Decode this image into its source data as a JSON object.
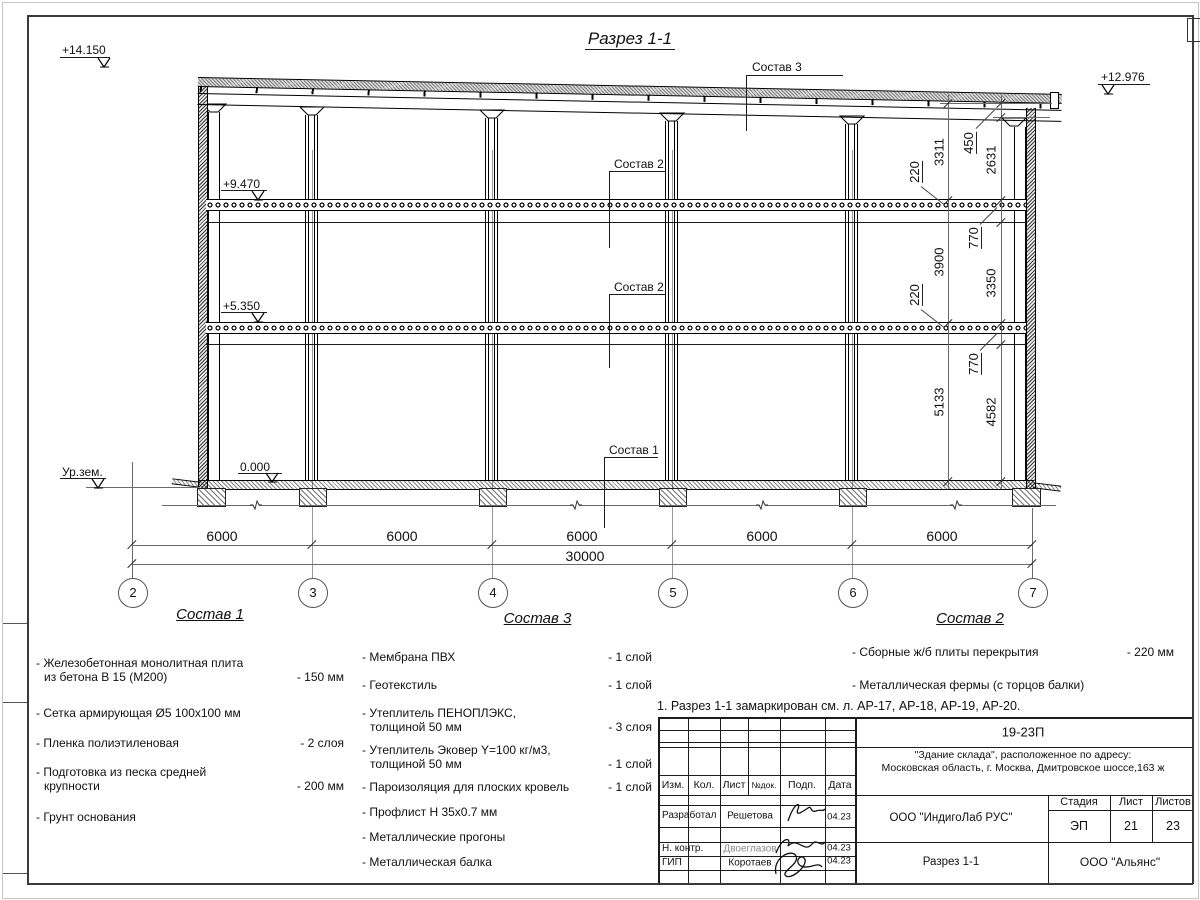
{
  "sheet": {
    "title": "Разрез 1-1",
    "note": "1. Разрез 1-1 замаркирован см. л. АР-17, АР-18, АР-19, АР-20."
  },
  "elevations": {
    "top_left": "+14.150",
    "top_right": "+12.976",
    "floor2": "+9.470",
    "floor1": "+5.350",
    "zero": "0.000",
    "ground": "Ур.зем."
  },
  "callouts": {
    "roof": "Состав 3",
    "slab_upper": "Состав 2",
    "slab_lower": "Состав 2",
    "floor_slab": "Состав 1"
  },
  "grid": {
    "labels": [
      "2",
      "3",
      "4",
      "5",
      "6",
      "7"
    ]
  },
  "dimensions": {
    "bottom_bays": [
      "6000",
      "6000",
      "6000",
      "6000",
      "6000"
    ],
    "bottom_total": "30000",
    "right_inner": [
      "3311",
      "3900",
      "5133"
    ],
    "right_outer": [
      "450",
      "2631",
      "770",
      "3350",
      "770",
      "4582"
    ],
    "slab_thickness": [
      "220",
      "220"
    ]
  },
  "legends": [
    {
      "title": "Состав 1",
      "items": [
        {
          "line1": "- Железобетонная  монолитная плита",
          "line2": "из бетона В 15 (М200)",
          "value": "- 150 мм"
        },
        {
          "line1": "- Сетка армирующая Ø5 100x100 мм",
          "line2": "",
          "value": ""
        },
        {
          "line1": "- Пленка полиэтиленовая",
          "line2": "",
          "value": "- 2 слоя"
        },
        {
          "line1": "- Подготовка из песка средней",
          "line2": "крупности",
          "value": "- 200 мм"
        },
        {
          "line1": "- Грунт основания",
          "line2": "",
          "value": ""
        }
      ]
    },
    {
      "title": "Состав 3",
      "items": [
        {
          "line1": "- Мембрана ПВХ",
          "line2": "",
          "value": "- 1 слой"
        },
        {
          "line1": "- Геотекстиль",
          "line2": "",
          "value": "- 1 слой"
        },
        {
          "line1": "- Утеплитель ПЕНОПЛЭКС,",
          "line2": "толщиной 50 мм",
          "value": "- 3 слоя"
        },
        {
          "line1": "- Утеплитель Эковер Y=100 кг/м3,",
          "line2": "толщиной 50 мм",
          "value": "- 1 слой"
        },
        {
          "line1": "- Пароизоляция для плоских кровель",
          "line2": "",
          "value": "- 1 слой"
        },
        {
          "line1": "- Профлист Н 35х0.7 мм",
          "line2": "",
          "value": ""
        },
        {
          "line1": "- Металлические прогоны",
          "line2": "",
          "value": ""
        },
        {
          "line1": "- Металлическая балка",
          "line2": "",
          "value": ""
        }
      ]
    },
    {
      "title": "Состав 2",
      "items": [
        {
          "line1": "- Сборные ж/б плиты перекрытия",
          "line2": "",
          "value": "- 220 мм"
        },
        {
          "line1": "- Металлическая фермы (с торцов балки)",
          "line2": "",
          "value": ""
        }
      ]
    }
  ],
  "title_block": {
    "doc_number": "19-23П",
    "project_line1": "\"Здание склада\", расположенное по адресу:",
    "project_line2": "Московская область, г. Москва, Дмитровское шоссе,163 ж",
    "columns": [
      "Изм.",
      "Кол.",
      "Лист",
      "№док.",
      "Подп.",
      "Дата"
    ],
    "rows": [
      {
        "role": "Разработал",
        "name": "Решетова",
        "date": "04.23"
      },
      {
        "role": "Н. контр.",
        "name": "Двоеглазов",
        "date": "04.23"
      },
      {
        "role": "ГИП",
        "name": "Коротаев",
        "date": "04.23"
      }
    ],
    "company": "ООО \"ИндигоЛаб РУС\"",
    "drawing_title": "Разрез 1-1",
    "contractor": "ООО \"Альянс\"",
    "stage_headers": [
      "Стадия",
      "Лист",
      "Листов"
    ],
    "stage": "ЭП",
    "sheet_no": "21",
    "sheets_total": "23"
  }
}
